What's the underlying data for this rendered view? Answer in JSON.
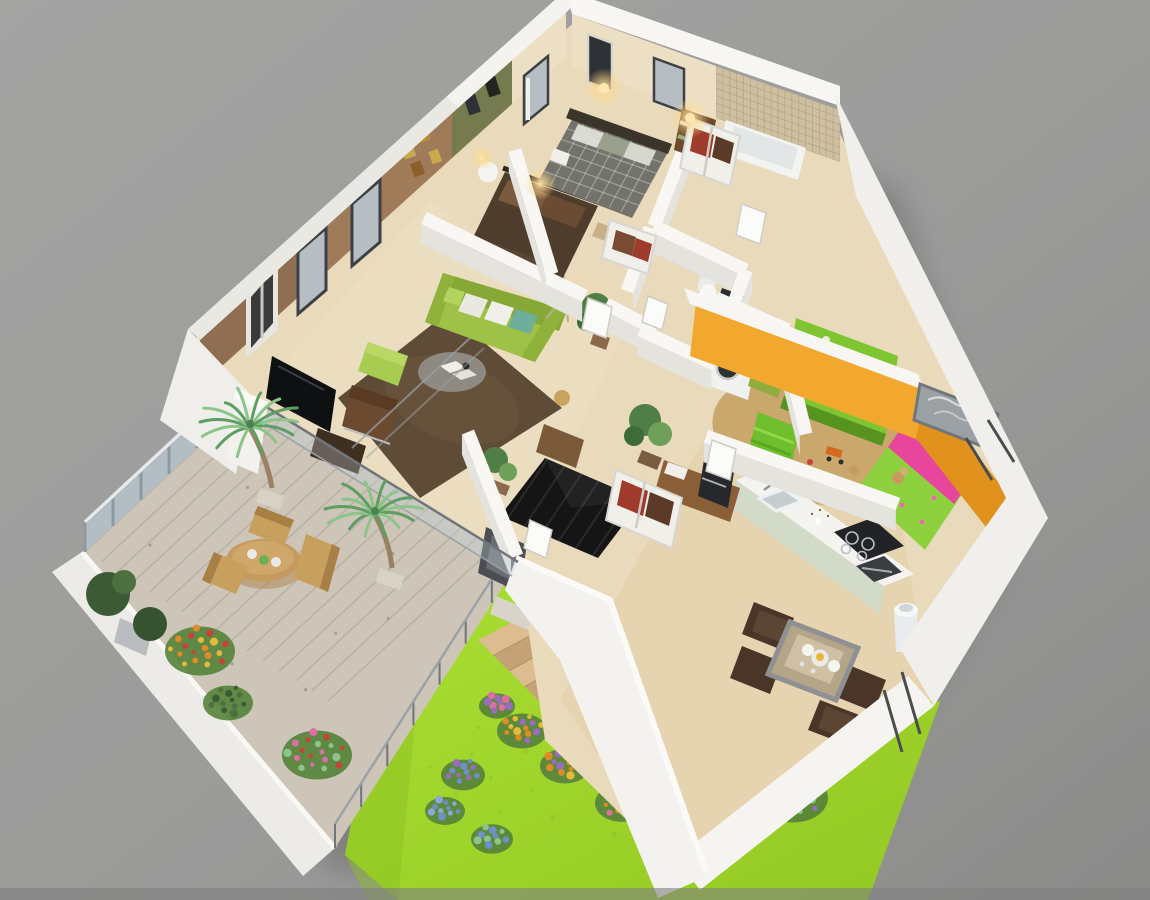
{
  "scene": {
    "type": "isometric-3d-floor-plan-render",
    "description": "Aerial cutaway 3D render of a three-bedroom apartment with living room, kitchen, dining area, two bathrooms, laundry, wooden roof terrace and a sloped garden lawn with wooden stairs",
    "background": "#9b9b9b"
  },
  "palette": {
    "bg": "#9b9b9b",
    "bg_light": "#a8a8a7",
    "bg_dark": "#8a8a89",
    "bg_strip": "#808080",
    "wall_white": "#f1f0ec",
    "wall_top": "#fafaf7",
    "wall_face": "#e4e3de",
    "wall_dim": "#d4d3cf",
    "floor": "#e8dabb",
    "floor_warm": "#e2cfa8",
    "accent_brown": "#8f6e52",
    "accent_brown_lit": "#a9825f",
    "accent_olive": "#757a4f",
    "accent_cream": "#ecdfc4",
    "tile_beige": "#cdbf9f",
    "accent_orange": "#f2a72e",
    "accent_orange_dark": "#e0921c",
    "rug_brown": "#5f4c36",
    "rug_black": "#151515",
    "sofa_green": "#9fc148",
    "sofa_green_dark": "#86a837",
    "pouf_green": "#a8cb52",
    "kids_green": "#8ed13e",
    "kids_pink": "#e8459c",
    "shelf_green": "#7fc531",
    "kids_floor": "#c7a265",
    "master_duvet": "#73736b",
    "headboard_dark": "#3b342b",
    "guest_duvet": "#4e3d2c",
    "guest_pillow": "#7b5a3e",
    "grass": "#a2d92e",
    "grass_dark": "#85ba1f",
    "deck_wood": "#ccc5b8",
    "deck_plank": "#aea począ",
    "plank_line": "#b1a899",
    "stair_wood": "#dcbd90",
    "stair_wood_dark": "#c5a276",
    "glass": "#c2d3de",
    "railing_post": "#8e99a1",
    "palm_green": "#5f9e63",
    "palm_light": "#8cc489",
    "shrub_green": "#3c5a33",
    "flower_orange": "#e08a28",
    "flower_red": "#c44536",
    "flower_pink": "#dd6fa6",
    "flower_purple": "#9a6cc0",
    "flower_blue": "#6d8fca",
    "flower_yellow": "#e6b93c",
    "wood": "#c49a5e",
    "wood_dark": "#a87f45",
    "dining_chair": "#4a3628",
    "dining_table": "#b4a488",
    "counter_white": "#f4f3f0",
    "cabinet_sage": "#d2dac8",
    "appliance_dark": "#212326",
    "steel": "#aab1b5",
    "door_dark": "#4b4e52",
    "glow_warm": "#ffd98a",
    "closet_red": "#9e3b2c",
    "closet_brown": "#5c3a28",
    "art_dark": "#2e3135",
    "frame_gray": "#9aa0a4",
    "window_glass": "#b6bec4",
    "window_frame": "#3c4044"
  },
  "rooms": [
    {
      "id": "master-bedroom",
      "label": "Master Bedroom",
      "accent": "#ecdfc4",
      "furniture": [
        "double-bed-checked-duvet",
        "wall-sconces",
        "wardrobe-shelves",
        "artwork",
        "bench"
      ]
    },
    {
      "id": "guest-bedroom",
      "label": "Second Bedroom",
      "accent": "#757a4f",
      "furniture": [
        "double-bed-brown",
        "round-side-table",
        "table-lamp",
        "wall-art",
        "closet"
      ]
    },
    {
      "id": "bathroom",
      "label": "Bathroom",
      "accent": "#cdbf9f",
      "furniture": [
        "bathtub",
        "mosaic-tile-wall",
        "towel-shelf"
      ]
    },
    {
      "id": "wc-laundry",
      "label": "WC / Laundry",
      "accent": "#f1f0ec",
      "furniture": [
        "toilet",
        "shower",
        "washing-machine",
        "laundry-basket"
      ]
    },
    {
      "id": "living-room",
      "label": "Living Room",
      "accent": "#8f6e52",
      "furniture": [
        "green-sofa",
        "green-pouf",
        "leather-chair",
        "shag-rug",
        "coffee-table",
        "tv",
        "tv-stand",
        "floor-lamp",
        "sideboard",
        "plants",
        "city-artwork",
        "windows"
      ]
    },
    {
      "id": "hallway",
      "label": "Hallway / Entry",
      "accent": "#e8dabb",
      "furniture": [
        "black-diamond-rug",
        "open-closet",
        "potted-plant",
        "coffee-machine-sideboard",
        "front-door"
      ]
    },
    {
      "id": "kids-bedroom",
      "label": "Kids Bedroom",
      "accent": "#f2a72e",
      "furniture": [
        "single-bed-green-pink",
        "toy-shelf",
        "bean-bag",
        "toy-box",
        "toys",
        "wall-picture"
      ]
    },
    {
      "id": "kitchen",
      "label": "Kitchen",
      "accent": "#d2dac8",
      "furniture": [
        "counter-with-sink",
        "cooktop",
        "oven",
        "trash-bin",
        "cups"
      ]
    },
    {
      "id": "dining-area",
      "label": "Dining Area",
      "accent": "#b4a488",
      "furniture": [
        "dining-table",
        "four-chairs",
        "plates"
      ]
    },
    {
      "id": "terrace-deck",
      "label": "Roof Terrace",
      "accent": "#ccc5b8",
      "furniture": [
        "round-wood-table",
        "three-wood-chairs",
        "two-palm-trees",
        "glass-railing",
        "planter-shrubs",
        "flower-bushes"
      ]
    },
    {
      "id": "garden",
      "label": "Garden Lawn",
      "accent": "#a2d92e",
      "furniture": [
        "wooden-stairs",
        "flower-beds",
        "blue-flower-bushes"
      ]
    }
  ]
}
